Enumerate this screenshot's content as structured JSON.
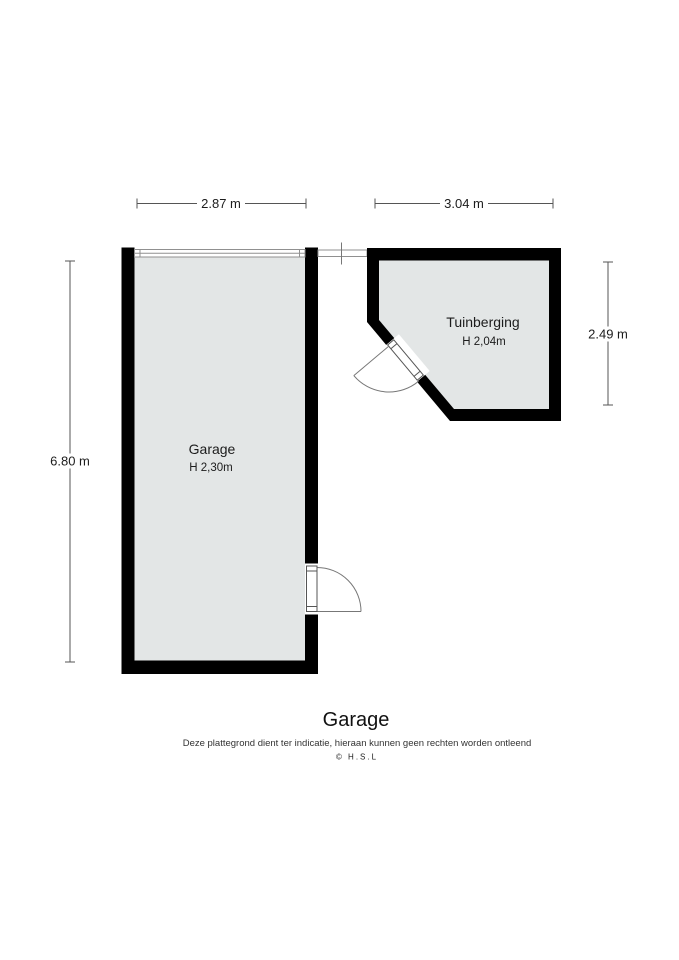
{
  "rooms": {
    "garage": {
      "label": "Garage",
      "height": "H 2,30m"
    },
    "tuinberging": {
      "label": "Tuinberging",
      "height": "H 2,04m"
    }
  },
  "dimensions": {
    "top_left": "2.87 m",
    "top_right": "3.04 m",
    "left": "6.80 m",
    "right": "2.49 m"
  },
  "footer": {
    "title": "Garage",
    "disclaimer": "Deze plattegrond dient ter indicatie, hieraan kunnen geen rechten worden ontleend",
    "watermark": "© H.S.L"
  },
  "colors": {
    "wall": "#000000",
    "room_fill": "#e3e6e6",
    "dim_line": "#555555",
    "door_line": "#777777",
    "opening_line": "#909090",
    "watermark": "#c7a494"
  }
}
